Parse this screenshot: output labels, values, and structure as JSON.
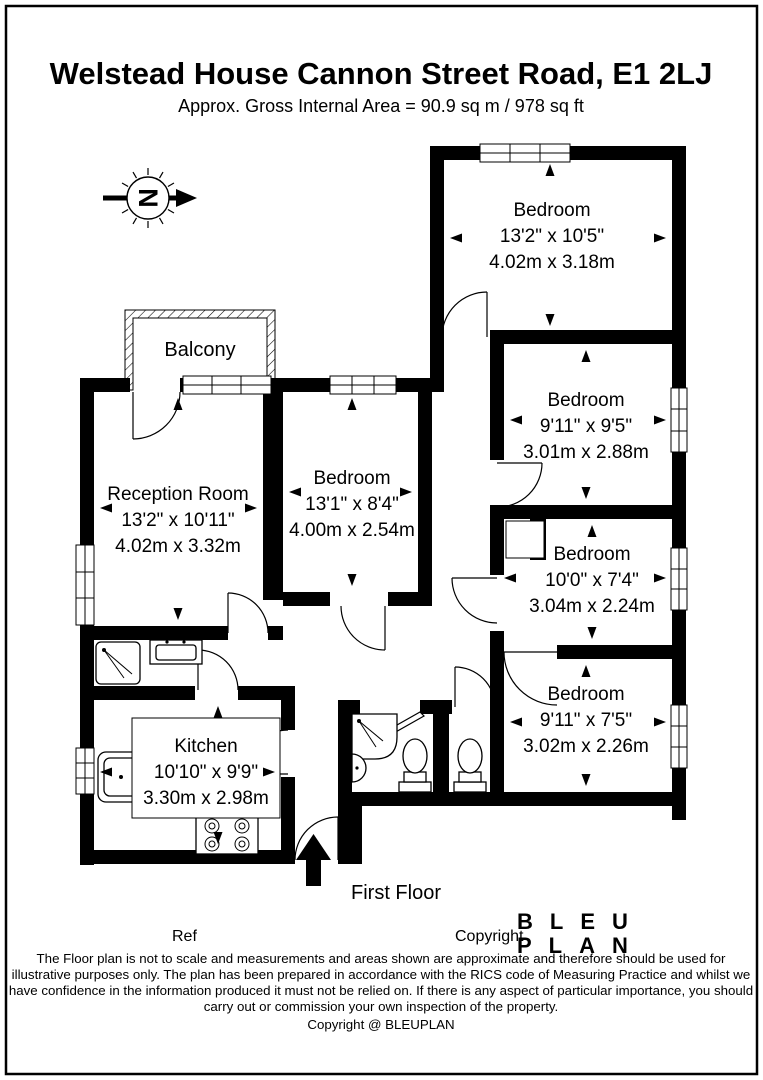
{
  "header": {
    "title": "Welstead House Cannon Street Road, E1 2LJ",
    "subtitle": "Approx. Gross Internal Area = 90.9 sq m / 978 sq ft"
  },
  "plan": {
    "north_label": "N",
    "balcony_label": "Balcony",
    "floor_label": "First Floor",
    "rooms": {
      "bedroom_top_right": {
        "name": "Bedroom",
        "imperial": "13'2\" x 10'5\"",
        "metric": "4.02m x 3.18m"
      },
      "bedroom_right_2": {
        "name": "Bedroom",
        "imperial": "9'11\" x 9'5\"",
        "metric": "3.01m x 2.88m"
      },
      "bedroom_right_3": {
        "name": "Bedroom",
        "imperial": "10'0\" x 7'4\"",
        "metric": "3.04m x 2.24m"
      },
      "bedroom_right_4": {
        "name": "Bedroom",
        "imperial": "9'11\" x 7'5\"",
        "metric": "3.02m x 2.26m"
      },
      "reception": {
        "name": "Reception Room",
        "imperial": "13'2\" x 10'11\"",
        "metric": "4.02m x 3.32m"
      },
      "bedroom_middle": {
        "name": "Bedroom",
        "imperial": "13'1\" x 8'4\"",
        "metric": "4.00m x 2.54m"
      },
      "kitchen": {
        "name": "Kitchen",
        "imperial": "10'10\" x 9'9\"",
        "metric": "3.30m x 2.98m"
      }
    }
  },
  "footer": {
    "ref_label": "Ref",
    "copyright_label": "Copyright",
    "logo": {
      "line1": "BLEU",
      "line2": "PLAN",
      "color": "#2b2b6e"
    },
    "disclaimer_lines": [
      "The Floor plan is not to scale and measurements and areas shown are approximate and therefore should be used for",
      "illustrative purposes only. The plan has been prepared in accordance with the RICS code of Measuring Practice and whilst we",
      "have confidence in the information produced it must not be relied on. If there is any aspect of particular importance, you should",
      "carry out or commission your own inspection of the property.",
      "Copyright @ BLEUPLAN"
    ]
  }
}
